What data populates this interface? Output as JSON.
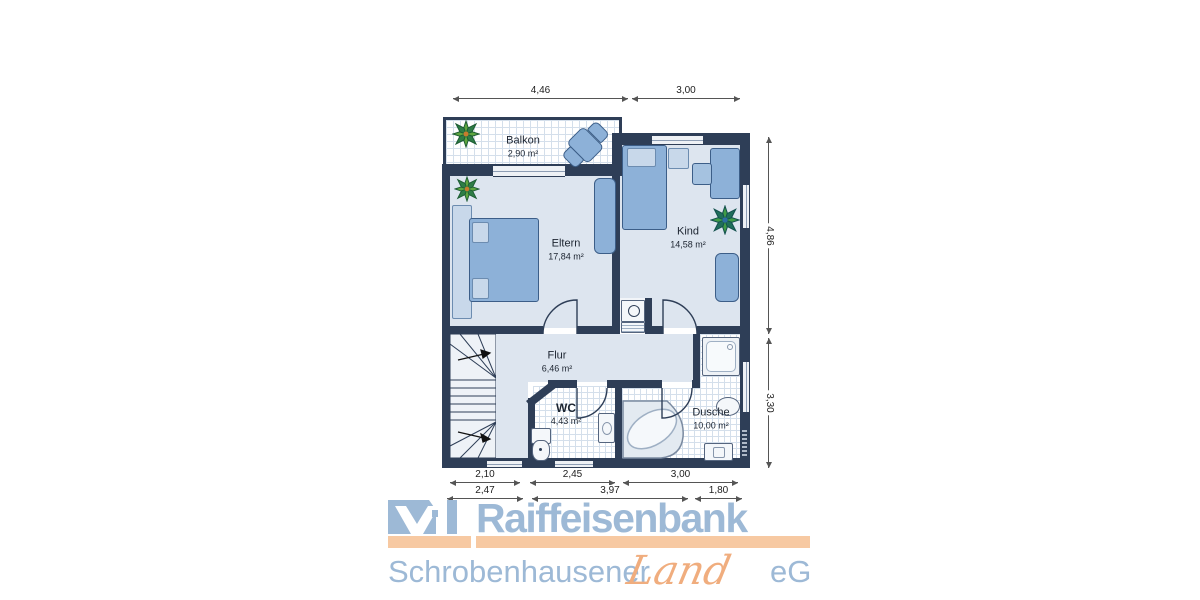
{
  "plan": {
    "rooms": {
      "balkon": {
        "name": "Balkon",
        "area": "2,90 m²"
      },
      "eltern": {
        "name": "Eltern",
        "area": "17,84 m²"
      },
      "kind": {
        "name": "Kind",
        "area": "14,58 m²"
      },
      "flur": {
        "name": "Flur",
        "area": "6,46 m²"
      },
      "wc": {
        "name": "WC",
        "area": "4,43 m²"
      },
      "dusche": {
        "name": "Dusche",
        "area": "10,00 m²"
      }
    },
    "dims": {
      "top1": "4,46",
      "top2": "3,00",
      "right1": "4,86",
      "right2": "3,30",
      "b1a": "2,10",
      "b1b": "2,45",
      "b1c": "3,00",
      "b2a": "2,47",
      "b2b": "3,97",
      "b2c": "1,80"
    },
    "colors": {
      "wall": "#2e3e57",
      "floor": "#dde5ef",
      "furniture": "#8db1d8",
      "accent_blue": "#9db9d6",
      "accent_orange": "#f7c9a2"
    }
  },
  "logo": {
    "line1": "Raiffeisenbank",
    "line2_left": "Schrobenhausener",
    "line2_script": "Land",
    "line2_right": "eG"
  }
}
